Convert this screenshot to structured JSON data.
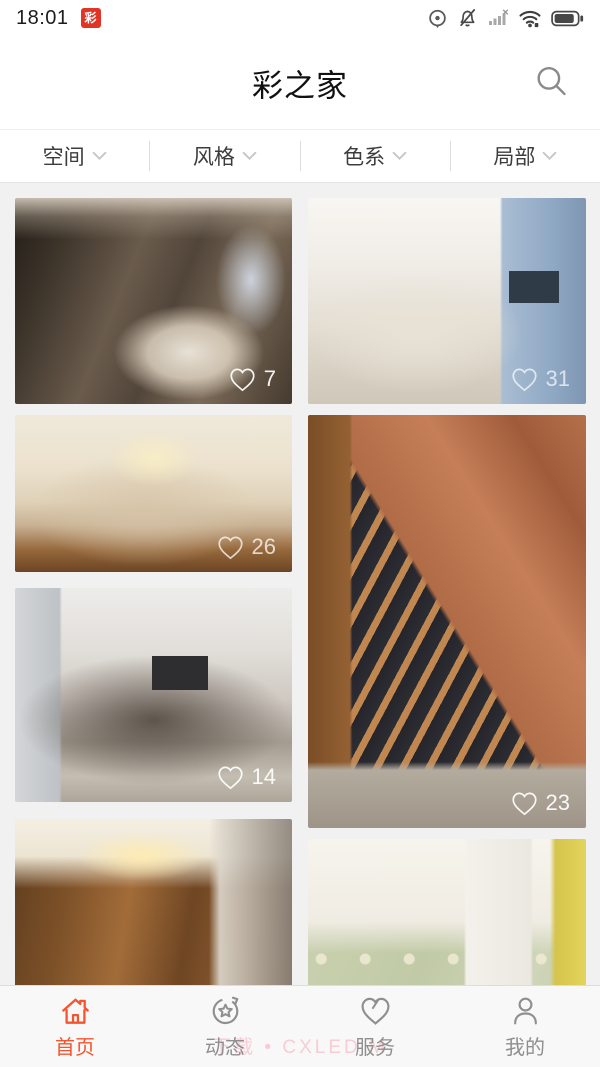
{
  "status_bar": {
    "time": "18:01",
    "app_badge": "彩",
    "right_icons": [
      "screen-record",
      "mute",
      "no-signal",
      "wifi",
      "battery"
    ]
  },
  "header": {
    "title": "彩之家"
  },
  "filter_bar": {
    "items": [
      {
        "label": "空间"
      },
      {
        "label": "风格"
      },
      {
        "label": "色系"
      },
      {
        "label": "局部"
      }
    ]
  },
  "feed": {
    "cards": [
      {
        "name": "dark-bathroom",
        "likes": "7"
      },
      {
        "name": "blue-living-room",
        "likes": "31"
      },
      {
        "name": "classic-bedroom",
        "likes": "26"
      },
      {
        "name": "brick-staircase",
        "likes": "23"
      },
      {
        "name": "gray-living-room",
        "likes": "14"
      },
      {
        "name": "wood-bedroom",
        "likes": ""
      },
      {
        "name": "floral-hallway",
        "likes": ""
      }
    ]
  },
  "bottom_nav": {
    "items": [
      {
        "label": "首页",
        "active": true
      },
      {
        "label": "动态",
        "active": false
      },
      {
        "label": "服务",
        "active": false
      },
      {
        "label": "我的",
        "active": false
      }
    ],
    "watermark": "下载 • CXLED M"
  },
  "colors": {
    "accent": "#f5552e",
    "feed_bg": "#f1f1f1",
    "like_text": "#ffffff"
  }
}
